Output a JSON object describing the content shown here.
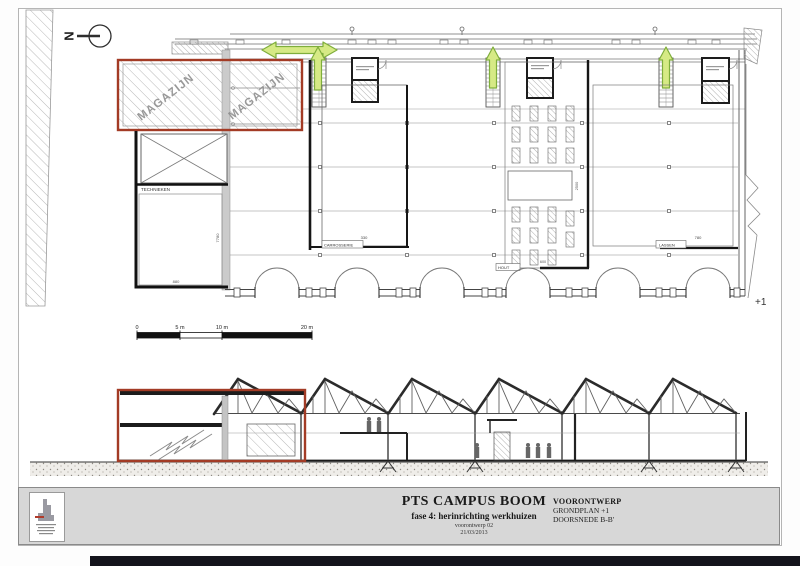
{
  "colors": {
    "red_outline": "#a33b25",
    "green_arrow_fill": "#d6ea85",
    "green_arrow_stroke": "#7fae3c",
    "titlebar_bg": "#d7d7d7",
    "bottom_bar": "#14141c"
  },
  "north": {
    "label": "N"
  },
  "plan": {
    "zones": {
      "magazijn_left": "MAGAZIJN",
      "magazijn_right": "MAGAZIJN",
      "technieken": "TECHNIEKEN",
      "carrosserie": "CARROSSERIE",
      "hout": "HOUT",
      "lassen": "LASSEN"
    },
    "level_marker": "+1",
    "dimensions": {
      "annex_depth": "7780",
      "annex_width": "880",
      "carrosserie": "330",
      "hout_table": "2500",
      "hout_bay": "600",
      "lassen": "780"
    }
  },
  "scale_bar": {
    "labels": [
      "0",
      "5 m",
      "10 m",
      "20 m"
    ]
  },
  "title_block": {
    "project_title": "PTS CAMPUS BOOM",
    "project_subtitle": "fase 4: herinrichting werkhuizen",
    "meta_line1": "voorontwerp 02",
    "meta_line2": "21/03/2013",
    "phase_label": "VOORONTWERP",
    "sheet_line1": "GRONDPLAN +1",
    "sheet_line2": "DOORSNEDE B-B'"
  }
}
